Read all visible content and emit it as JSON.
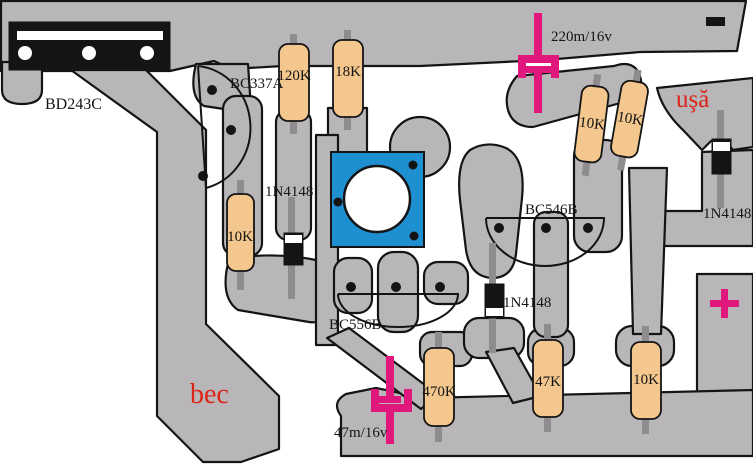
{
  "palette": {
    "copper": "#b9b6b9",
    "outline": "#141414",
    "resistor": "#f3c78d",
    "lead": "#8f8c8f",
    "cap_magenta": "#e0187e",
    "pad_blue": "#1e8fd0",
    "label_red": "#dd2418",
    "background": "#ffffff"
  },
  "transistors": {
    "power": "BD243C",
    "t337": "BC337A",
    "t556": "BC556B",
    "t546": "BC546B"
  },
  "diodes": [
    {
      "label": "1N4148",
      "position": "left"
    },
    {
      "label": "1N4148",
      "position": "center"
    },
    {
      "label": "1N4148",
      "position": "right"
    }
  ],
  "capacitors": [
    {
      "label": "220m/16v",
      "position": "top"
    },
    {
      "label": "47m/16v",
      "position": "bottom"
    }
  ],
  "resistors": [
    {
      "value": "120K",
      "position": "top-left"
    },
    {
      "value": "18K",
      "position": "top-middle"
    },
    {
      "value": "10K",
      "position": "mid-left"
    },
    {
      "value": "10K",
      "position": "right-upper-left"
    },
    {
      "value": "10K",
      "position": "right-upper-right"
    },
    {
      "value": "470K",
      "position": "bottom-left"
    },
    {
      "value": "47K",
      "position": "bottom-middle"
    },
    {
      "value": "10K",
      "position": "bottom-right"
    }
  ],
  "nets": {
    "bulb": "bec",
    "door": "uşă"
  },
  "symbols": {
    "plus_terminal": "plus-cross",
    "minus_terminal": "minus-dash"
  }
}
